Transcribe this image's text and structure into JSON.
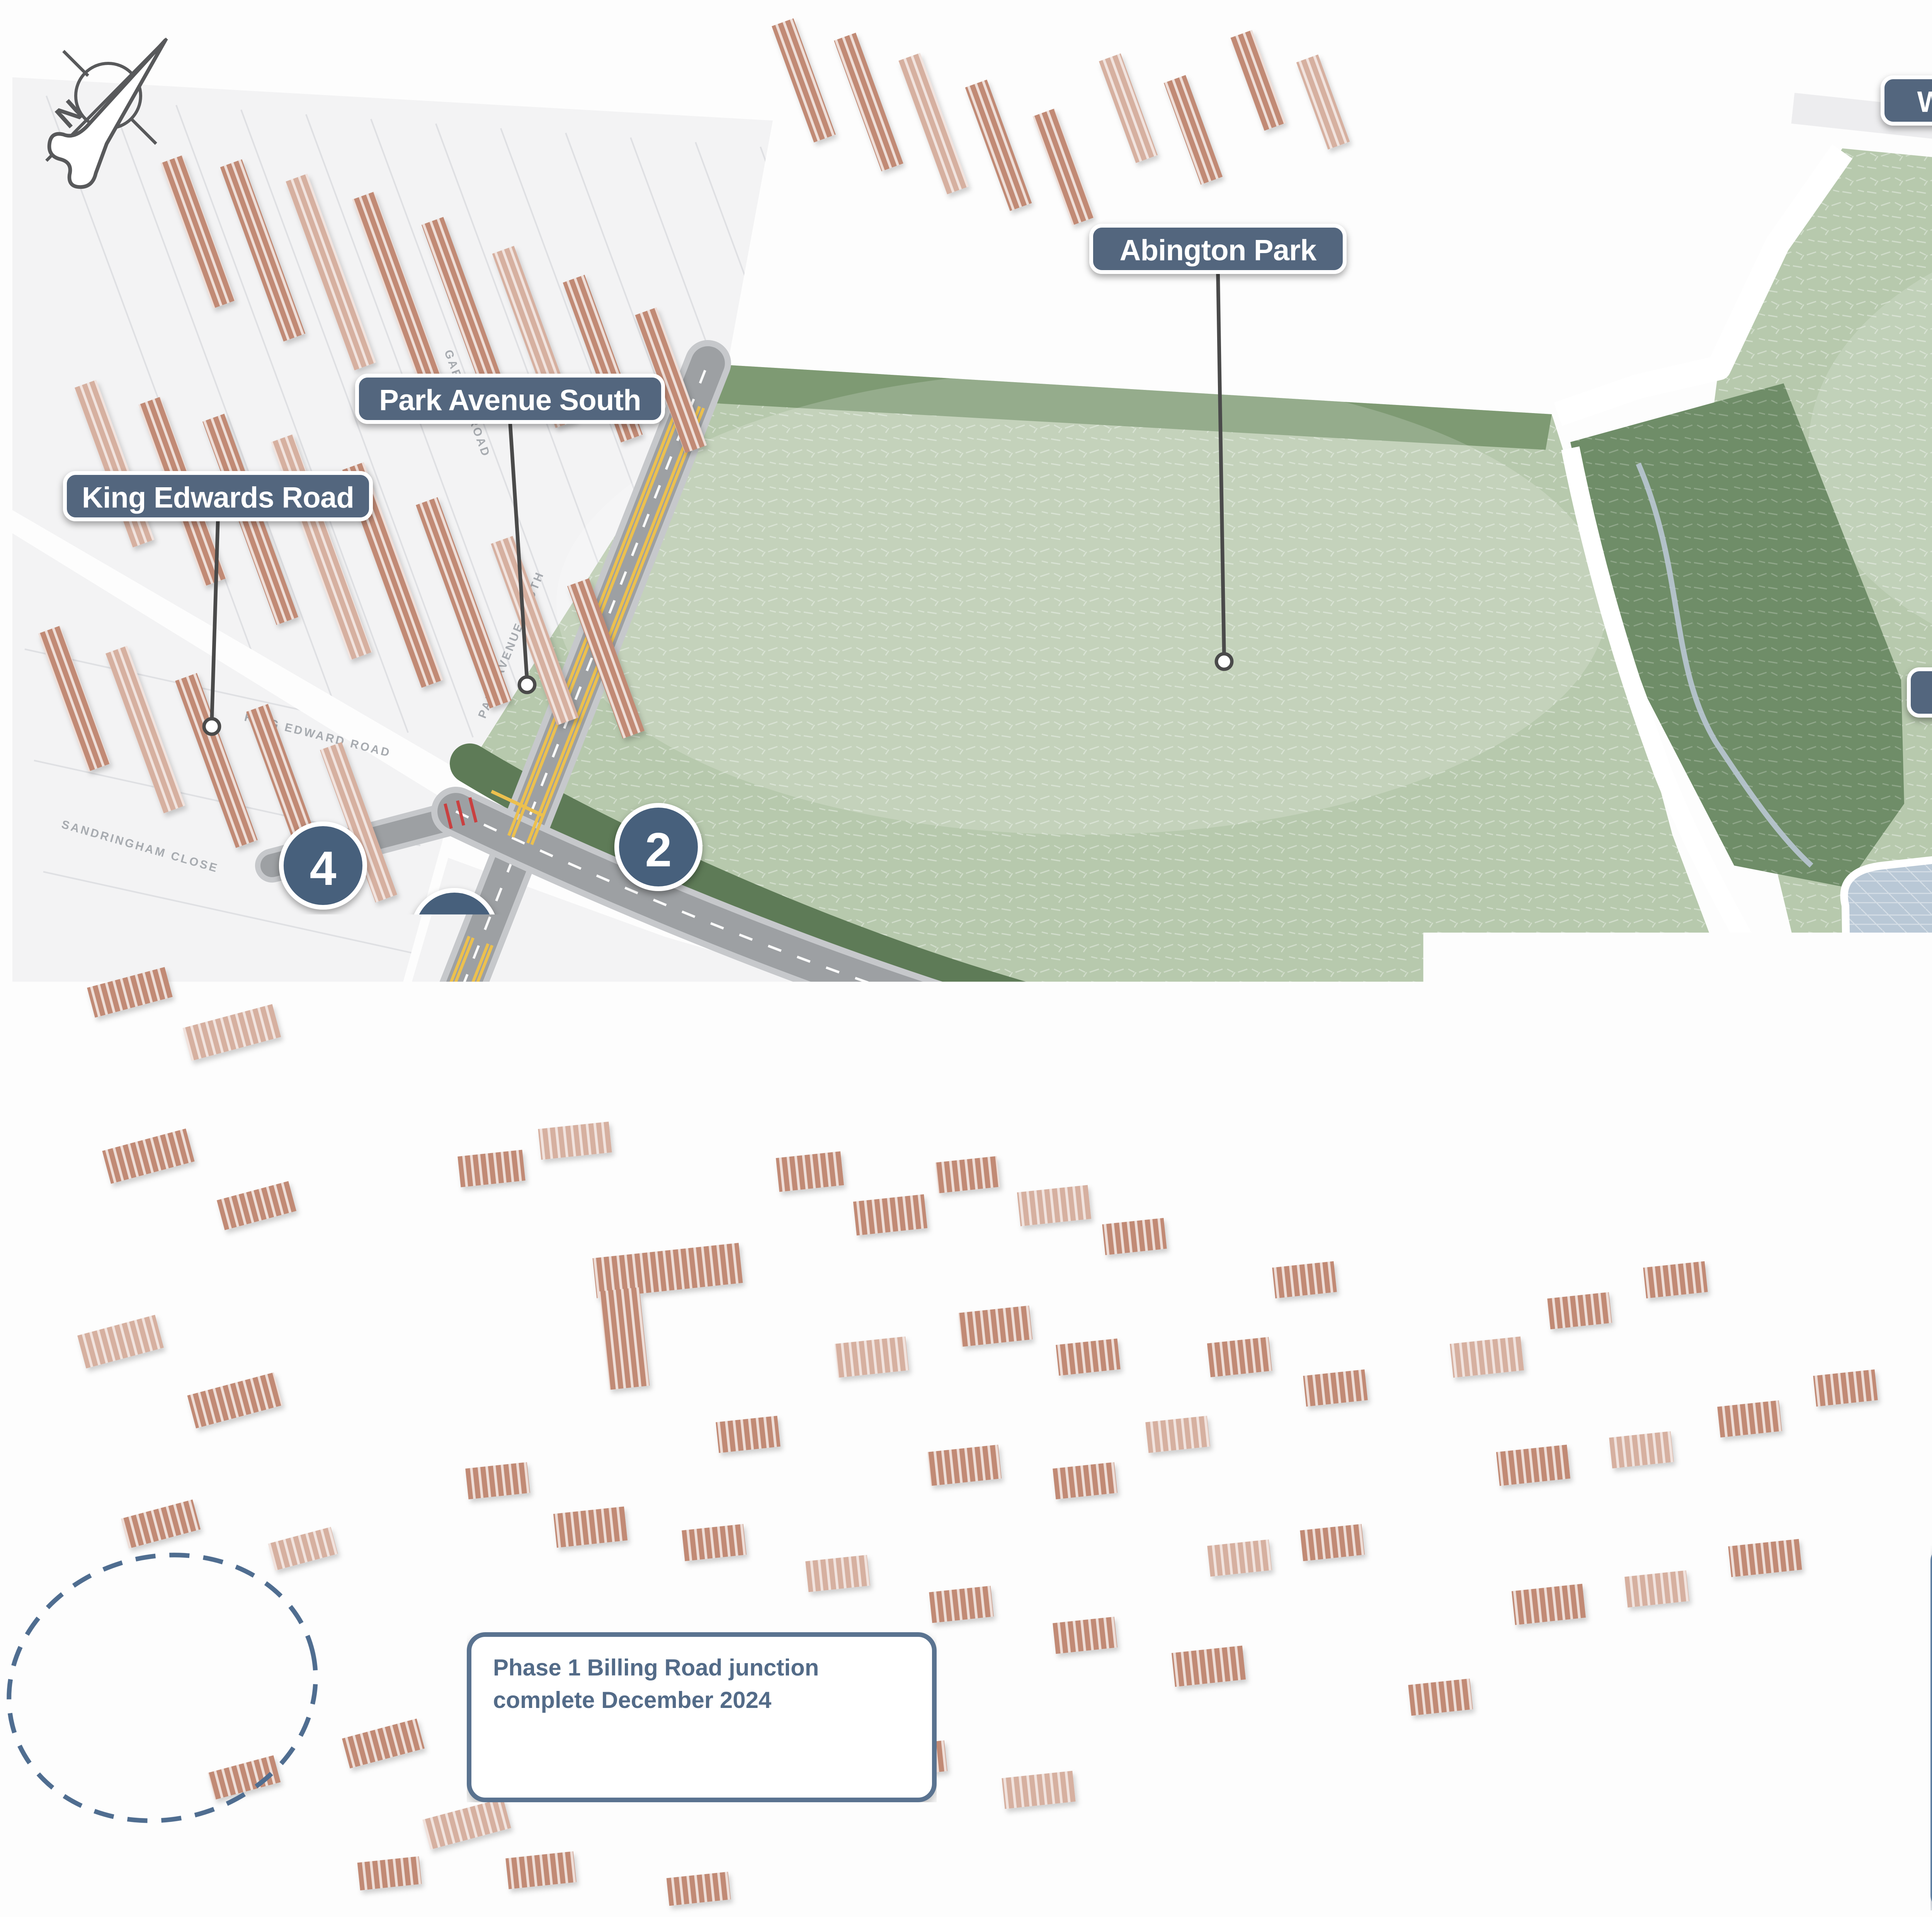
{
  "title": "Abington Park improvement scheme map",
  "compass": {
    "letter": "N"
  },
  "labels": [
    {
      "id": "wellingborough-road",
      "text": "Wellingborough Road"
    },
    {
      "id": "weston-way",
      "text": "Weston Way"
    },
    {
      "id": "abington-park",
      "text": "Abington Park"
    },
    {
      "id": "park-avenue-south-top",
      "text": "Park Avenue South"
    },
    {
      "id": "king-edwards-road",
      "text": "King Edwards Road"
    },
    {
      "id": "bridgewater-drive",
      "text": "Bridgewater Drive"
    },
    {
      "id": "abington-park-crescent-east",
      "text": "Abington Park Crescent"
    },
    {
      "id": "abington-park-crescent-west",
      "text": "Abington Park Crescent"
    },
    {
      "id": "park-avenue-south-bottom",
      "text": "Park Avenue South"
    },
    {
      "id": "landcross-drive",
      "text": "Landcross Drive"
    }
  ],
  "markers": [
    {
      "n": "4"
    },
    {
      "n": "1"
    },
    {
      "n": "2"
    },
    {
      "n": "3"
    },
    {
      "n": "2"
    },
    {
      "n": "4"
    },
    {
      "n": "3"
    },
    {
      "n": "1"
    },
    {
      "n": "3"
    },
    {
      "n": "3"
    }
  ],
  "legend": {
    "items": [
      {
        "num": "1.",
        "text": "Improved and safer Toucan crossing for pedestrians and cyclists."
      },
      {
        "num": "2.",
        "text": "Dedicated car parking facilities."
      },
      {
        "num": "3.",
        "text": "Improved walkway and cycleway."
      },
      {
        "num": "4.",
        "text": "Road closed & footpath extended."
      }
    ]
  },
  "note": {
    "text": "Phase 1 Billing Road junction complete December 2024"
  },
  "streets": [
    "GARRICK ROAD",
    "KING EDWARD ROAD",
    "SANDRINGHAM CLOSE",
    "PARK AVENUE SOUTH",
    "ABINGTON PARK CRESCENT",
    "ABINGTON PARK CRESCENT",
    "BILLING ROAD EAST",
    "ST CHRISTOPHER'S WALK",
    "Tennis Courts",
    "The Spinney",
    "WESTON WAY"
  ],
  "colors": {
    "label_bg": "#53667e",
    "label_text": "#ffffff",
    "marker_bg": "#46607c",
    "leader_line": "#4a4a4a",
    "legend_border": "#5f7fa2",
    "legend_text": "#566d86",
    "park_green": "#b7c9ad",
    "park_dark_band": "#7e9a73",
    "woodland": "#6f8d68",
    "tree": "#243725",
    "pond": "#b9c8d6",
    "building": "#c18a74",
    "road": "#9da0a3",
    "road_casing": "#c6c8cb",
    "yellow_line": "#ecc04e",
    "crossing_red": "#c94040",
    "closure_green": "#72995e",
    "dashed_circle": "#4f6d90"
  }
}
